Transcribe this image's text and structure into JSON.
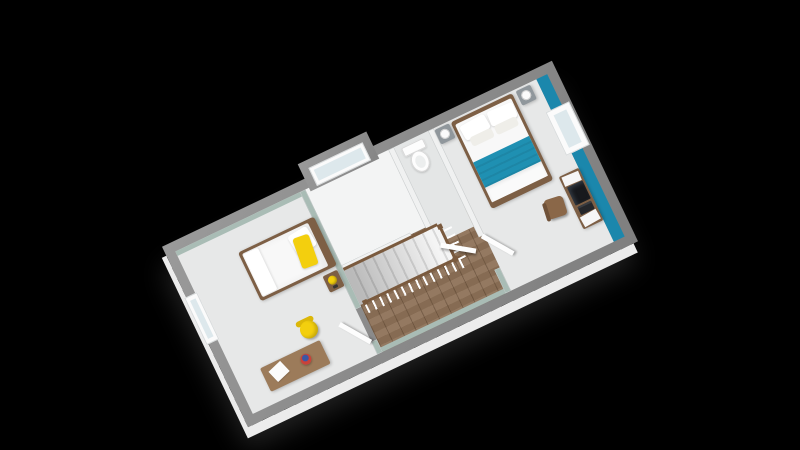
{
  "scene": {
    "title": "3D isometric floor plan render of an upper storey on a black background",
    "view": "rotated isometric top-down",
    "background": "#000000"
  },
  "colors": {
    "background": "#000000",
    "exterior_wall": "#8c8c8c",
    "interior_wall": "#f0f1f1",
    "sage_wall": "#a9bcb5",
    "accent_teal": "#1b87ac",
    "teal_blanket": "#1f90b2",
    "wood_floor": "#8d7157",
    "light_floor": "#e7e8e8",
    "bathroom_floor": "#f3f4f4",
    "wc_floor": "#e4e6e6",
    "furniture_wood": "#7d5f45",
    "desk_wood": "#9c7b5a",
    "rail_wood": "#7a5a3e",
    "nightstand_gray": "#90979c",
    "accent_yellow": "#f3cf0e",
    "white_bedding": "#f8f8f8",
    "white_face": "#ececec"
  },
  "rooms": [
    {
      "id": "master-bedroom",
      "label": "Master bedroom with double bed, teal accent wall, desk and chair"
    },
    {
      "id": "second-bedroom",
      "label": "Second bedroom with single bed, yellow pillow, yellow chair and desk"
    },
    {
      "id": "bathroom",
      "label": "Bathroom with bay window"
    },
    {
      "id": "wc",
      "label": "WC with toilet"
    },
    {
      "id": "landing",
      "label": "Wood-floored landing with staircase and railing"
    }
  ],
  "objects": {
    "master_bedroom": [
      "double-bed",
      "teal-throw",
      "white-pillows",
      "nightstand-west",
      "nightstand-east",
      "sphere-lamp-west",
      "sphere-lamp-east",
      "desk",
      "monitor",
      "desk-papers",
      "desk-chair",
      "east-window",
      "teal-accent-wall",
      "door"
    ],
    "second_bedroom": [
      "single-bed",
      "yellow-pillow",
      "nightstand",
      "yellow-lamp",
      "phone",
      "desk",
      "paper",
      "globe",
      "yellow-chair",
      "west-window",
      "door"
    ],
    "bathroom": [
      "bay-window"
    ],
    "wc": [
      "toilet",
      "door"
    ],
    "landing": [
      "staircase",
      "stair-railing-south",
      "stair-railing-east",
      "railing-posts",
      "wood-floor"
    ]
  }
}
